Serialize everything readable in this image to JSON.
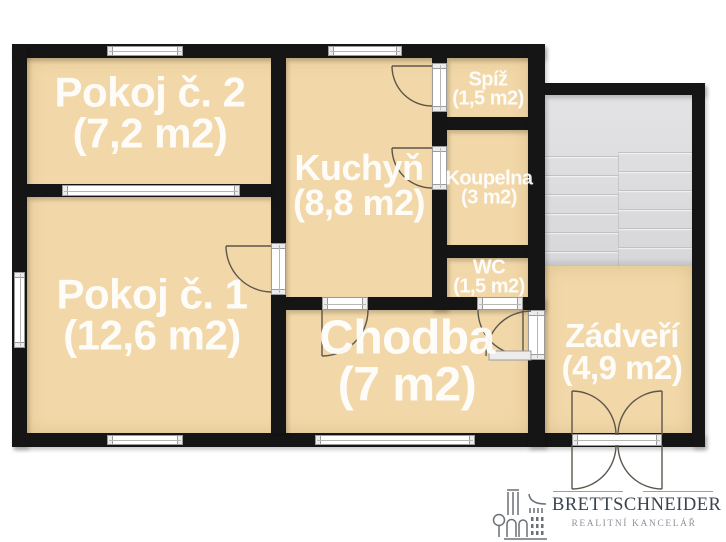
{
  "rooms": [
    {
      "name": "Pokoj č. 2",
      "area": "(7,2 m2)"
    },
    {
      "name": "Pokoj č. 1",
      "area": "(12,6 m2)"
    },
    {
      "name": "Kuchyň",
      "area": "(8,8 m2)"
    },
    {
      "name": "Spíž",
      "area": "(1,5 m2)"
    },
    {
      "name": "Koupelna",
      "area": "(3 m2)"
    },
    {
      "name": "WC",
      "area": "(1,5 m2)"
    },
    {
      "name": "Chodba",
      "area": "(7 m2)"
    },
    {
      "name": "Zádveří",
      "area": "(4,9 m2)"
    }
  ],
  "branding": {
    "name": "BRETTSCHNEIDER",
    "tagline": "REALITNÍ KANCELÁŘ"
  },
  "colors": {
    "floor": "#f2d8a8",
    "wall": "#151515",
    "stairs": "#dedee0",
    "stair_line": "#c2c2c6",
    "door_arc": "#5d564c",
    "window_frame": "#9b9b9b",
    "logo_dark": "#3a434e",
    "logo_muted": "#8d939b",
    "background": "#ffffff",
    "label_text": "#ffffff"
  }
}
